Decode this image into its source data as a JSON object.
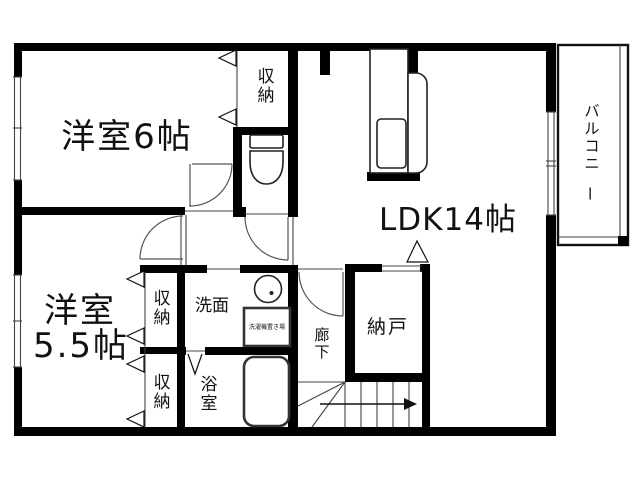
{
  "floorplan": {
    "rooms": {
      "western6": {
        "label": "洋室6帖"
      },
      "ldk": {
        "label": "LDK14帖"
      },
      "western55": {
        "label_line1": "洋室",
        "label_line2": "5.5帖"
      },
      "balcony": {
        "label": "バルコニー"
      },
      "nando": {
        "label": "納戸"
      },
      "hallway": {
        "label": "廊下"
      },
      "washroom": {
        "label": "洗面"
      },
      "bathroom": {
        "label": "浴室"
      },
      "closet_top": {
        "label": "収納"
      },
      "closet_mid": {
        "label": "収納"
      },
      "closet_bottom": {
        "label": "収納"
      },
      "washer_space": {
        "label": "洗濯機置き場"
      }
    },
    "colors": {
      "wall": "#000000",
      "background": "#ffffff",
      "line": "#444444"
    }
  }
}
